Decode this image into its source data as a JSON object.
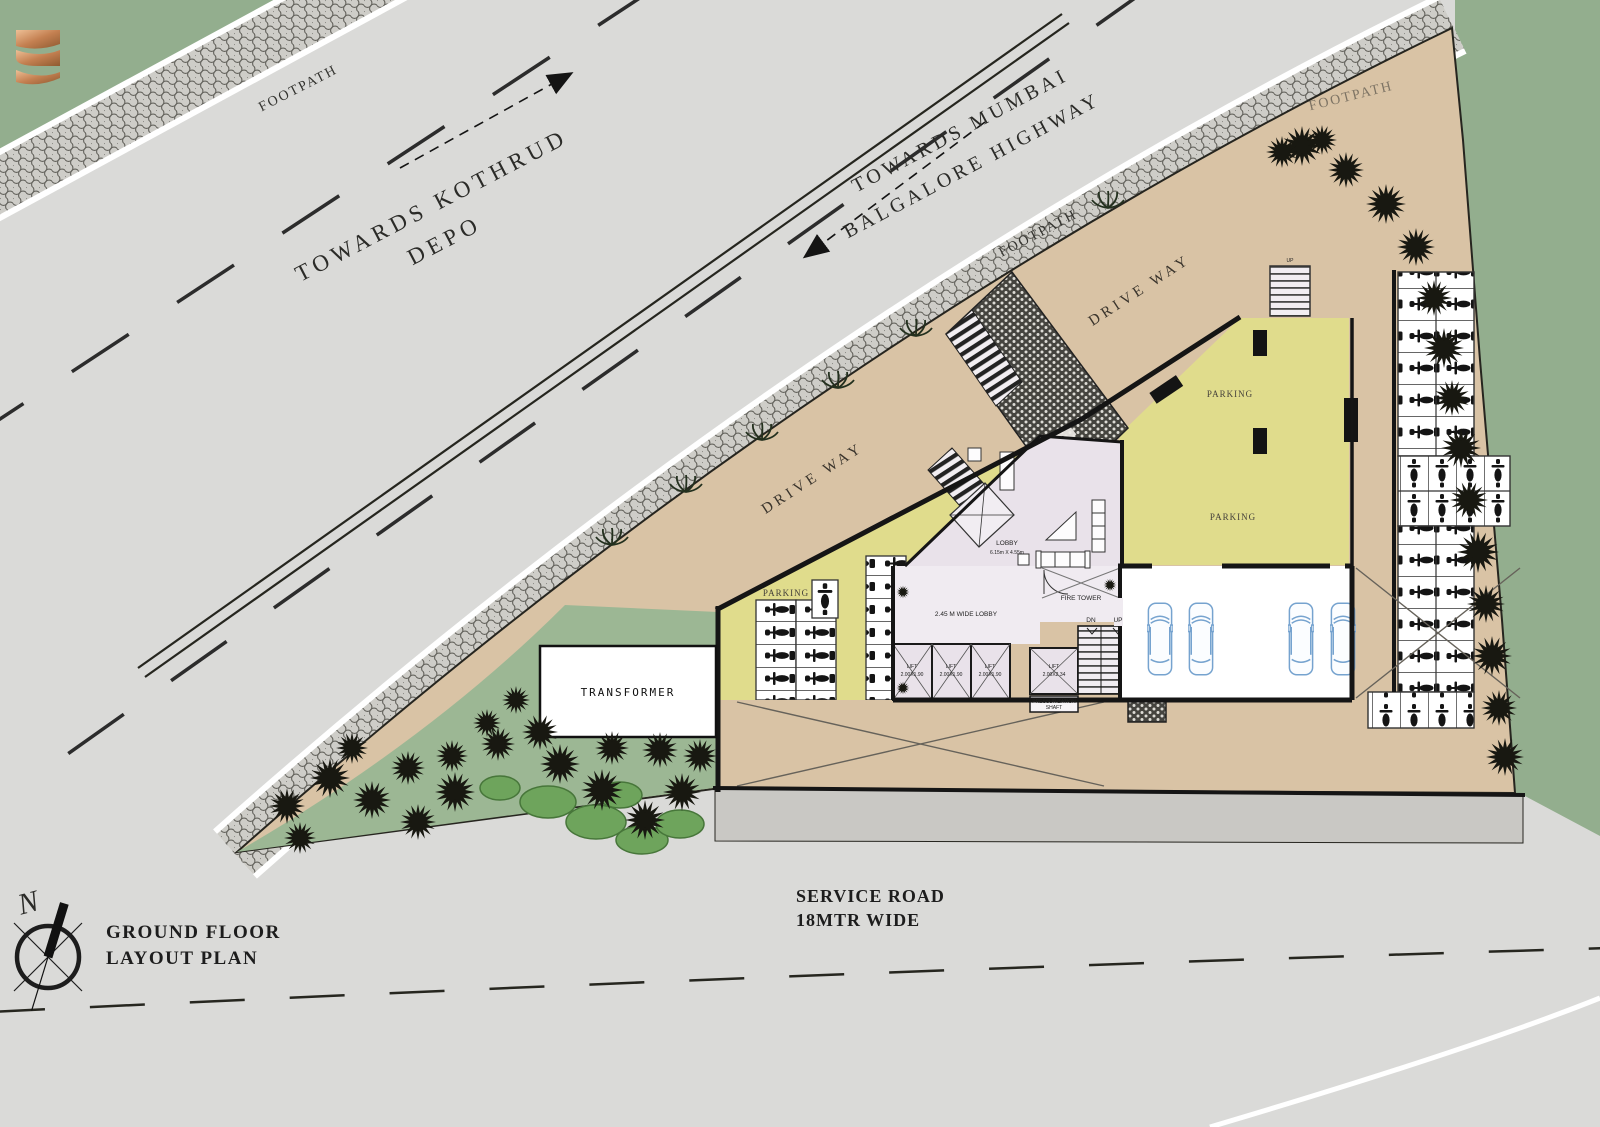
{
  "roads": {
    "footpath_label": "FOOTPATH",
    "towards_kothrud_line1": "TOWARDS KOTHRUD",
    "towards_kothrud_line2": "DEPO",
    "towards_mumbai_line1": "TOWARDS MUMBAI",
    "towards_mumbai_line2": "BALGALORE  HIGHWAY",
    "service_road_line1": "SERVICE ROAD",
    "service_road_line2": "18MTR WIDE"
  },
  "site": {
    "drive_way_label": "DRIVE WAY",
    "parking_label": "PARKING",
    "transformer_label": "TRANSFORMER",
    "foyer_label": "FOYER",
    "entry_label": "ENTRY",
    "up_label": "UP"
  },
  "core": {
    "lobby_label": "LOBBY",
    "lobby_dim": "6.15m X 4.55m",
    "wide_lobby_label": "2.45 M WIDE LOBBY",
    "fire_tower_label": "FIRE TOWER",
    "lift_label": "LIFT",
    "lift_small_dim": "2.00X1.90",
    "lift_large_dim": "2.00X2.34",
    "pressurization_line1": "PRESSURIZATION",
    "pressurization_line2": "SHAFT",
    "dn_label": "DN",
    "up_label": "UP"
  },
  "titleblock": {
    "north_letter": "N",
    "title_line1": "GROUND FLOOR",
    "title_line2": "LAYOUT PLAN"
  },
  "colors": {
    "background_green": "#93ae8e",
    "road_gray": "#dadad8",
    "site_tan": "#d9c3a5",
    "parking_yellow": "#e0dc8c",
    "lobby_lavender": "#e9e2ea",
    "landscape_green": "#9cb794",
    "car_blue": "#76a3cf",
    "logo_copper": "#c48051"
  }
}
